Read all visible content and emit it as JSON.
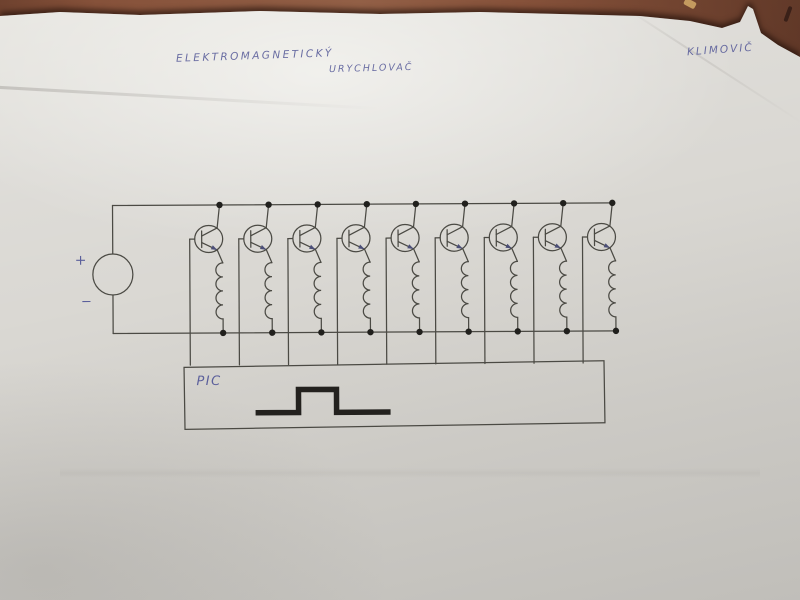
{
  "handwriting": {
    "title_line1": "ELEKTROMAGNETICKÝ",
    "title_line2": "URYCHLOVAČ",
    "author": "KLIMOVIČ",
    "pen_color": "#5b5f9b"
  },
  "schematic": {
    "stage_count": 9,
    "power_supply": {
      "plus_label": "+",
      "minus_label": "−"
    },
    "controller": {
      "label": "PIC",
      "waveform": "square-pulse"
    },
    "ink_color": "#4b4a44",
    "pulse_color": "#23211e",
    "dot_color": "#21201d"
  },
  "colors": {
    "desk": "#7c452e",
    "paper": "#d9d7d2"
  }
}
